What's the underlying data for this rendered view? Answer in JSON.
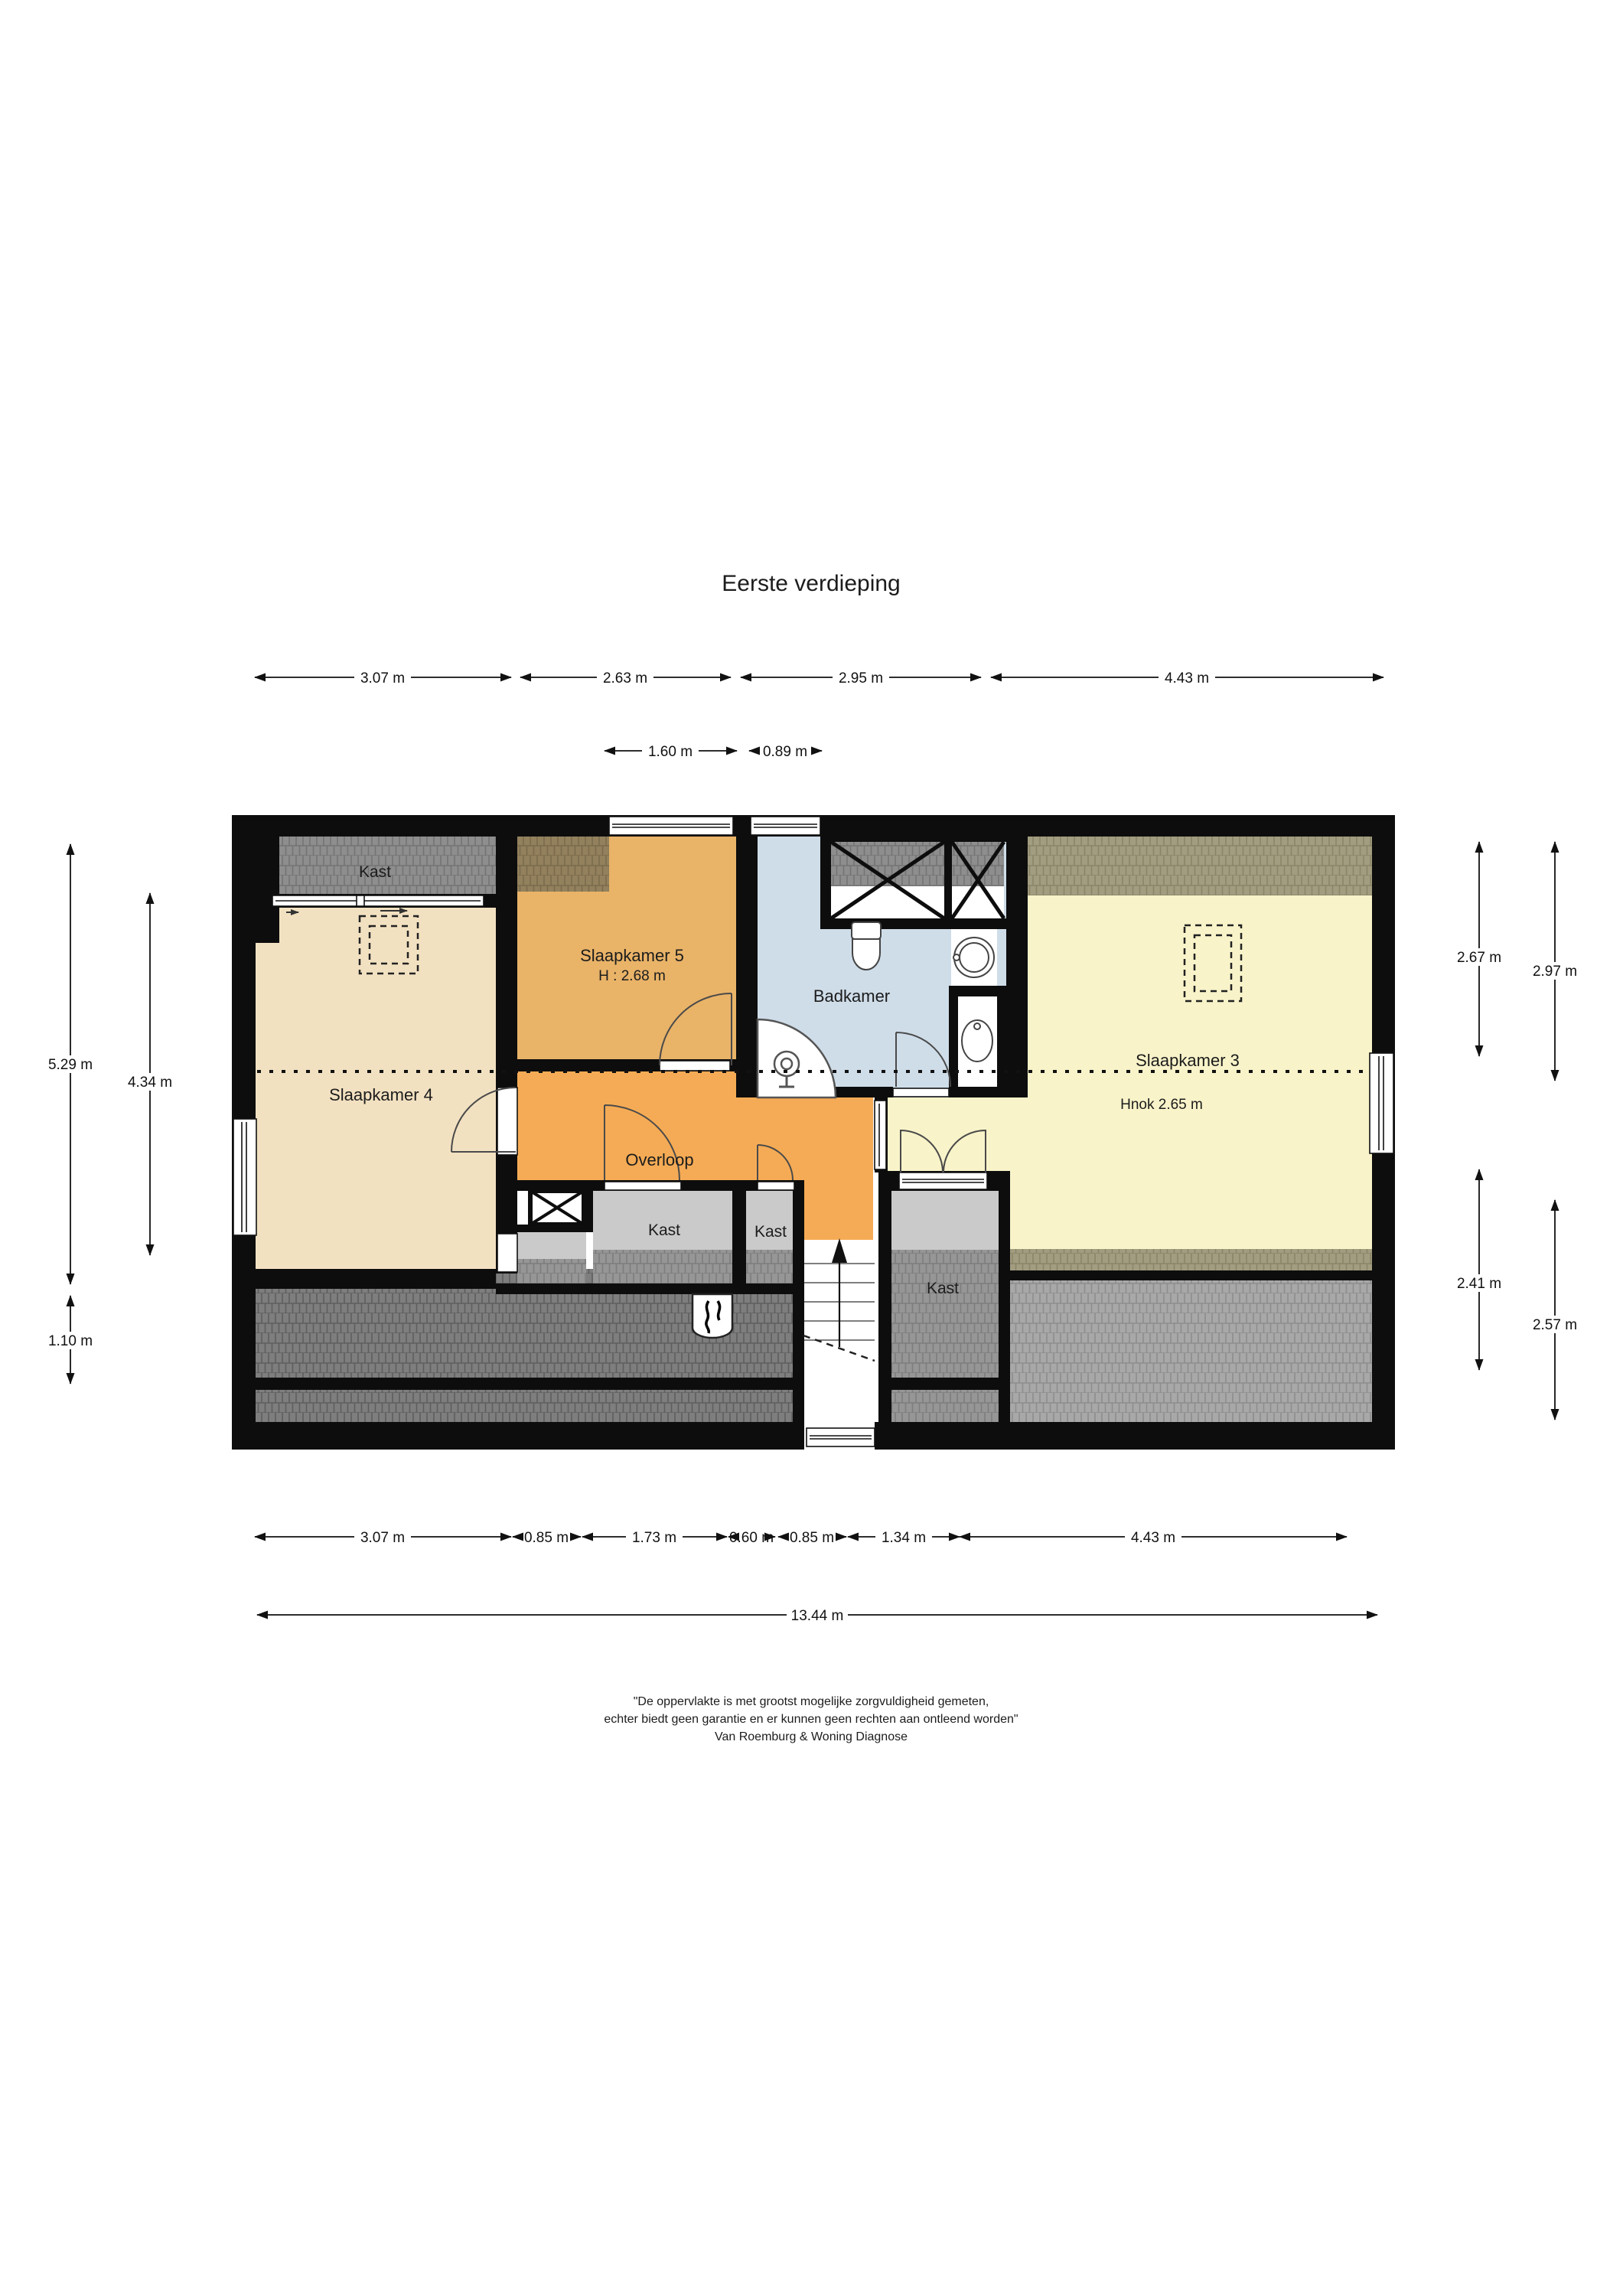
{
  "page": {
    "title": "Eerste verdieping"
  },
  "floor_plan": {
    "rooms": {
      "kast_top_left": {
        "label": "Kast"
      },
      "slaapkamer_5": {
        "label": "Slaapkamer 5",
        "height_note": "H : 2.68 m"
      },
      "badkamer": {
        "label": "Badkamer"
      },
      "slaapkamer_4": {
        "label": "Slaapkamer 4"
      },
      "slaapkamer_3": {
        "label": "Slaapkamer 3",
        "height_note": "Hnok 2.65 m"
      },
      "overloop": {
        "label": "Overloop"
      },
      "kast_center_left": {
        "label": "Kast"
      },
      "kast_center_right": {
        "label": "Kast"
      },
      "kast_right": {
        "label": "Kast"
      }
    },
    "colors": {
      "slaapkamer_4": "#f2e1c1",
      "slaapkamer_5": "#e9b368",
      "overloop": "#f5ab55",
      "badkamer": "#cfdde9",
      "slaapkamer_3": "#f8f3c9",
      "closet_gray": "#cacaca",
      "wall": "#0d0d0d"
    }
  },
  "dimensions": {
    "top": [
      "3.07 m",
      "2.63 m",
      "2.95 m",
      "4.43 m"
    ],
    "top_inner": [
      "1.60 m",
      "0.89 m"
    ],
    "left": [
      "5.29 m",
      "4.34 m",
      "1.10 m"
    ],
    "right": [
      "2.67 m",
      "2.97 m",
      "2.41 m",
      "2.57 m"
    ],
    "bottom": [
      "3.07 m",
      "0.85 m",
      "1.73 m",
      "0.60 m",
      "0.85 m",
      "1.34 m",
      "4.43 m"
    ],
    "total_width": "13.44 m"
  },
  "disclaimer": {
    "line1": "\"De oppervlakte is met grootst mogelijke zorgvuldigheid gemeten,",
    "line2": "echter biedt geen garantie en er kunnen geen rechten aan ontleend worden\"",
    "line3": "Van Roemburg & Woning Diagnose"
  }
}
